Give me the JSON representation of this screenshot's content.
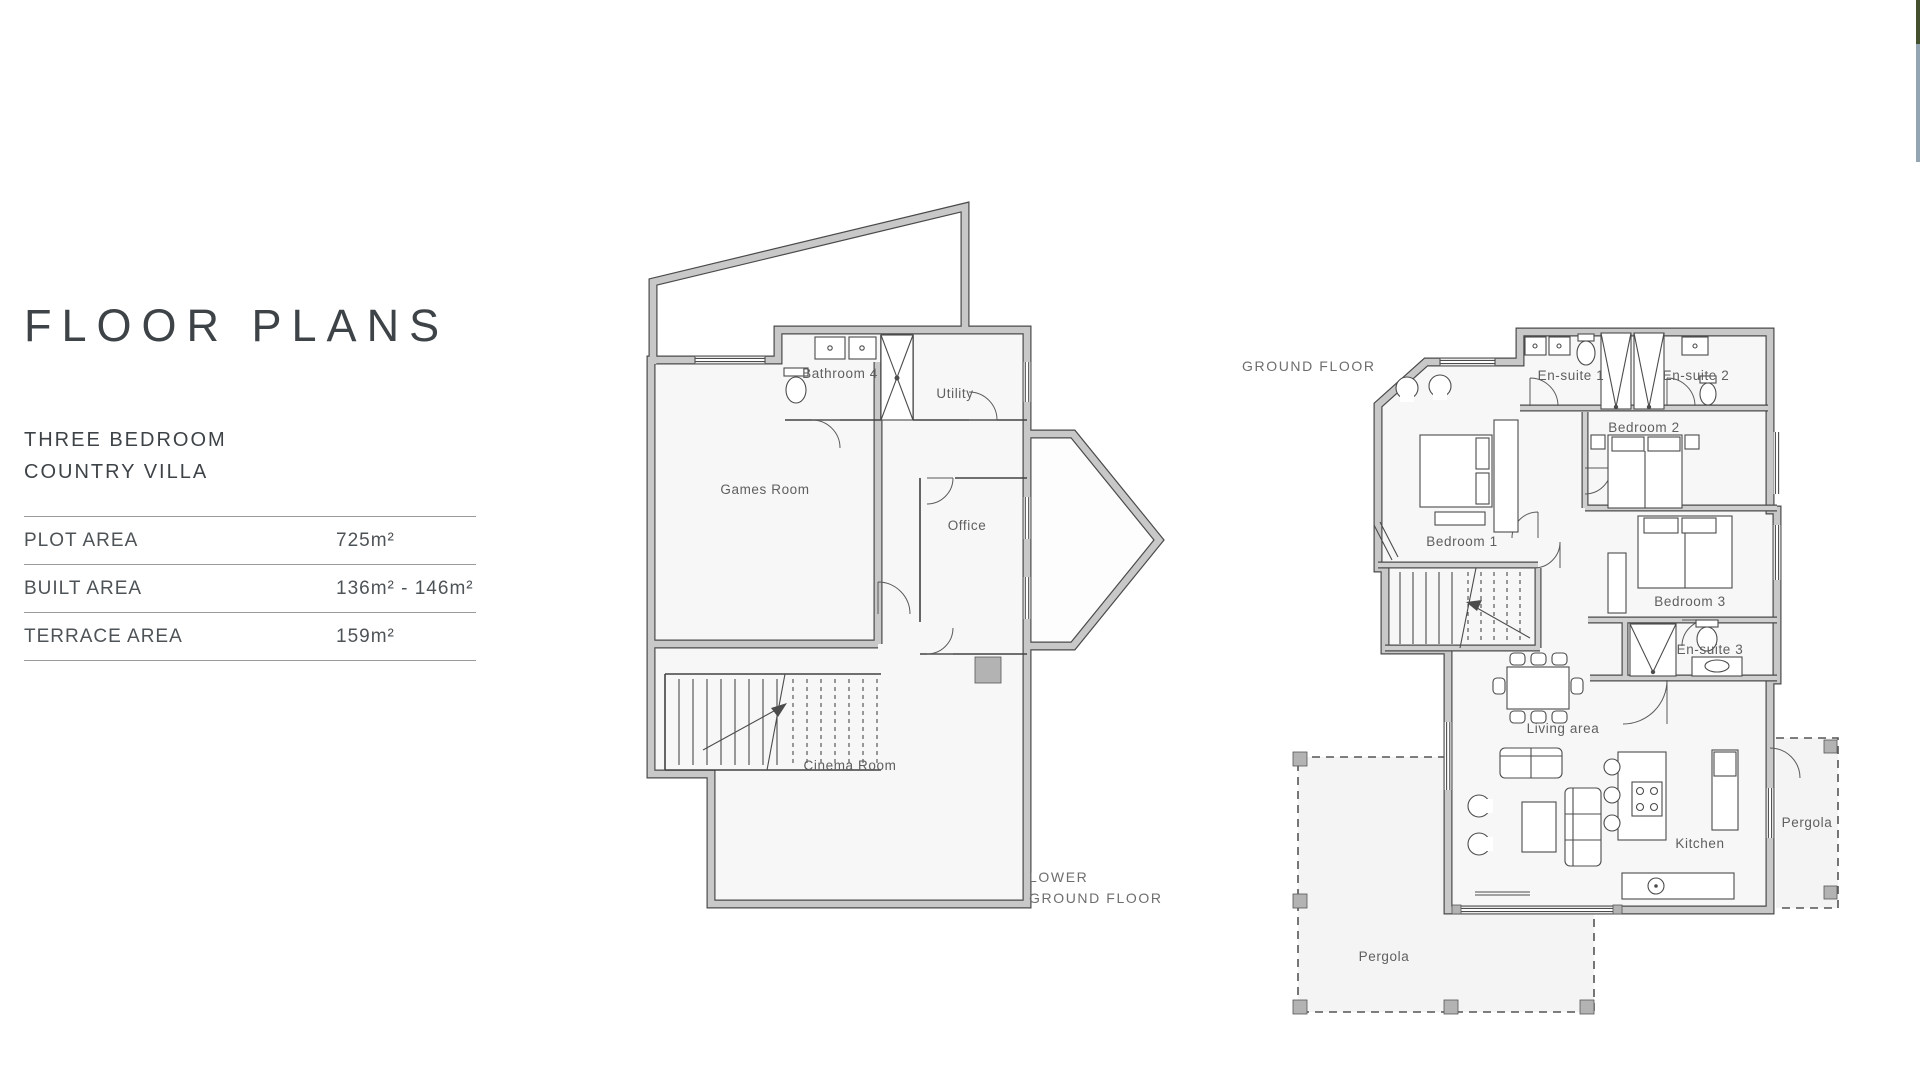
{
  "window": {
    "width": 1920,
    "height": 1069,
    "background": "#ffffff"
  },
  "side_preview_strip": {
    "top_color": "#45502f",
    "bottom_color": "#93a4b3"
  },
  "left_panel": {
    "title": "FLOOR PLANS",
    "subtitle_line1": "THREE BEDROOM",
    "subtitle_line2": "COUNTRY VILLA",
    "specs": [
      {
        "label": "PLOT AREA",
        "value": "725m²"
      },
      {
        "label": "BUILT AREA",
        "value": "136m² - 146m²"
      },
      {
        "label": "TERRACE AREA",
        "value": "159m²"
      }
    ]
  },
  "lower_ground_floor": {
    "floor_label_line1": "LOWER",
    "floor_label_line2": "GROUND FLOOR",
    "rooms": {
      "bathroom4": "Bathroom 4",
      "utility": "Utility",
      "games_room": "Games Room",
      "office": "Office",
      "cinema_room": "Cinema Room"
    }
  },
  "ground_floor": {
    "floor_label": "GROUND FLOOR",
    "rooms": {
      "ensuite1": "En-suite 1",
      "ensuite2": "En-suite 2",
      "bedroom1": "Bedroom 1",
      "bedroom2": "Bedroom 2",
      "bedroom3": "Bedroom 3",
      "ensuite3": "En-suite 3",
      "living_area": "Living area",
      "kitchen": "Kitchen",
      "pergola_right": "Pergola",
      "pergola_left": "Pergola"
    }
  },
  "colors": {
    "wall_fill": "#c8c8c8",
    "wall_edge": "#4a4a4a",
    "room_fill": "#f7f7f7",
    "label": "#5f5f5f",
    "title": "#3e4347",
    "divider": "#9a9a9a"
  }
}
